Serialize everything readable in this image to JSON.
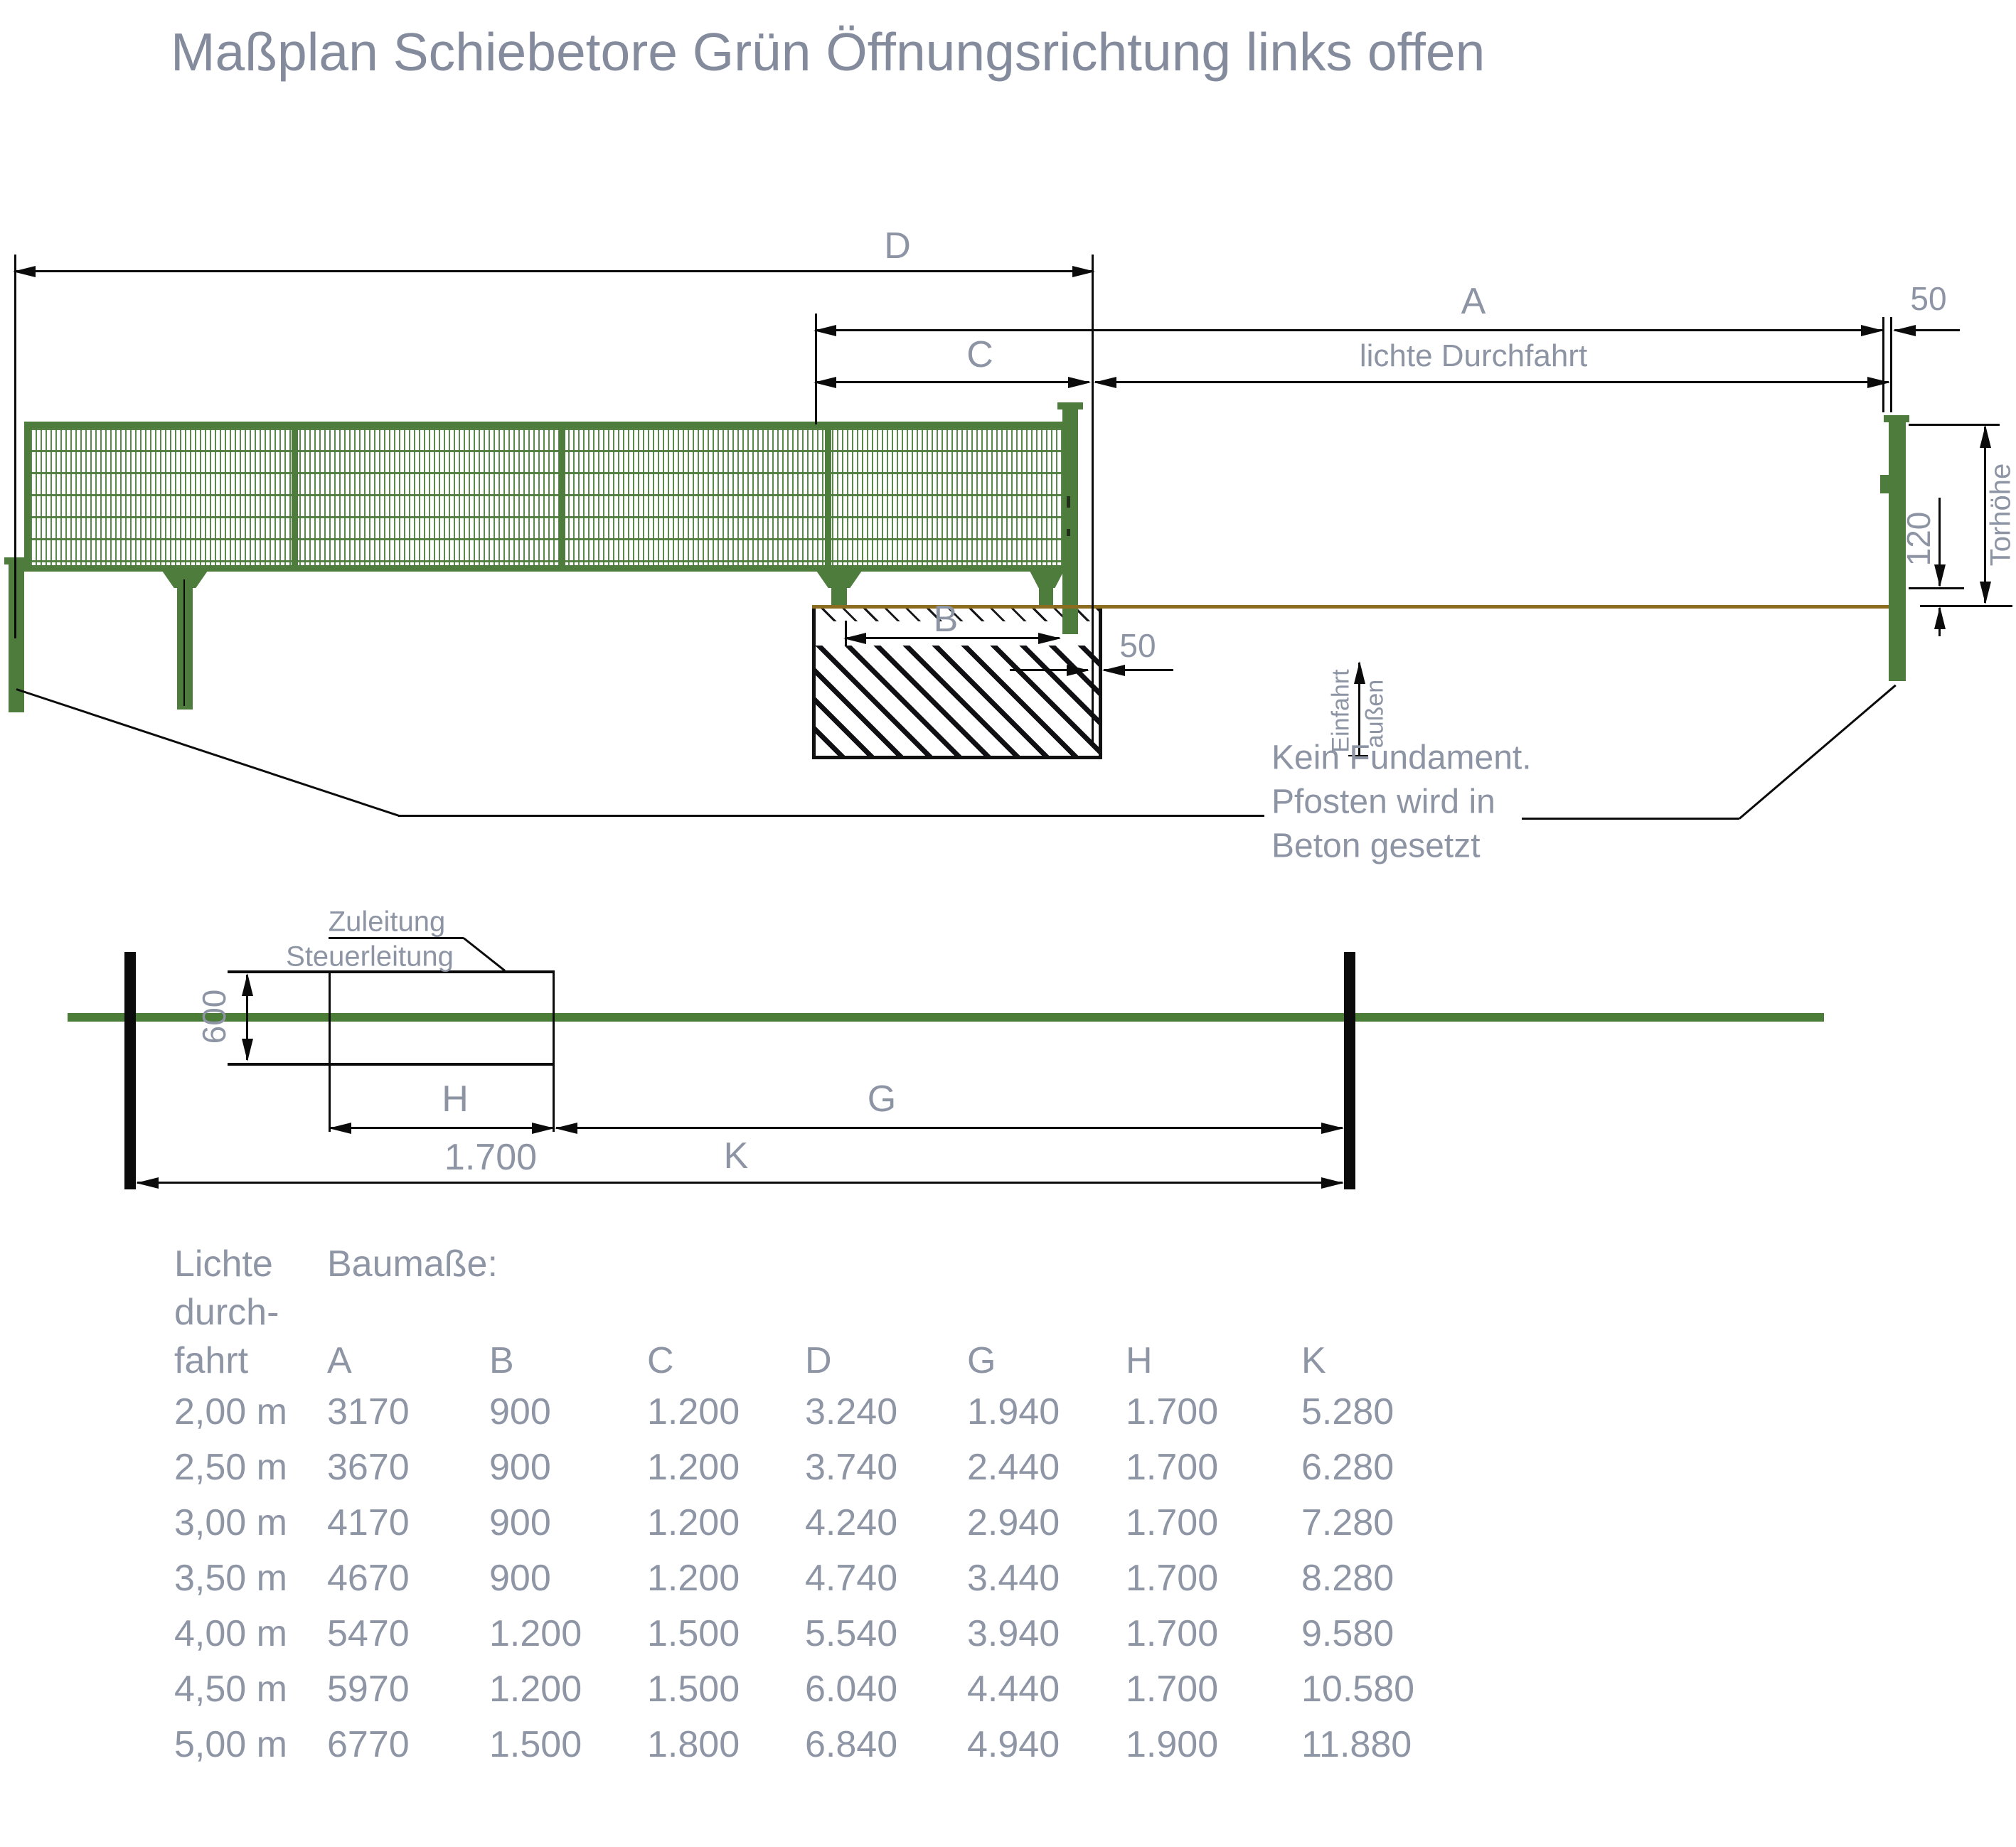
{
  "title": "Maßplan Schiebetore Grün Öffnungsrichtung links offen",
  "labels": {
    "dim_d": "D",
    "dim_a": "A",
    "dim_c": "C",
    "dim_b": "B",
    "clear_passage": "lichte Durchfahrt",
    "post_width_50": "50",
    "foundation_gap_50": "50",
    "gate_height": "Torhöhe",
    "ground_clearance_120": "120",
    "entry": "Einfahrt",
    "outside": "außen",
    "note_line1": "Kein Fundament.",
    "note_line2": "Pfosten wird in",
    "note_line3": "Beton gesetzt",
    "supply_line": "Zuleitung",
    "control_line": "Steuerleitung",
    "dim_600": "600",
    "dim_h": "H",
    "dim_h_value": "1.700",
    "dim_g": "G",
    "dim_k": "K"
  },
  "table": {
    "row_header_lines": [
      "Lichte",
      "durch-",
      "fahrt"
    ],
    "group_header": "Baumaße:",
    "columns": [
      "A",
      "B",
      "C",
      "D",
      "G",
      "H",
      "K"
    ],
    "rows": [
      [
        "2,00 m",
        "3170",
        "900",
        "1.200",
        "3.240",
        "1.940",
        "1.700",
        "5.280"
      ],
      [
        "2,50 m",
        "3670",
        "900",
        "1.200",
        "3.740",
        "2.440",
        "1.700",
        "6.280"
      ],
      [
        "3,00 m",
        "4170",
        "900",
        "1.200",
        "4.240",
        "2.940",
        "1.700",
        "7.280"
      ],
      [
        "3,50 m",
        "4670",
        "900",
        "1.200",
        "4.740",
        "3.440",
        "1.700",
        "8.280"
      ],
      [
        "4,00 m",
        "5470",
        "1.200",
        "1.500",
        "5.540",
        "3.940",
        "1.700",
        "9.580"
      ],
      [
        "4,50 m",
        "5970",
        "1.200",
        "1.500",
        "6.040",
        "4.440",
        "1.700",
        "10.580"
      ],
      [
        "5,00 m",
        "6770",
        "1.500",
        "1.800",
        "6.840",
        "4.940",
        "1.900",
        "11.880"
      ]
    ]
  },
  "colors": {
    "text_gray": "#8d94a4",
    "gate_green": "#4d7c3c",
    "mesh_green": "#5a8a4c",
    "line_black": "#0b0b0b",
    "ground_brown": "#8c6d1f",
    "fence_line_green": "#4b7d39"
  }
}
